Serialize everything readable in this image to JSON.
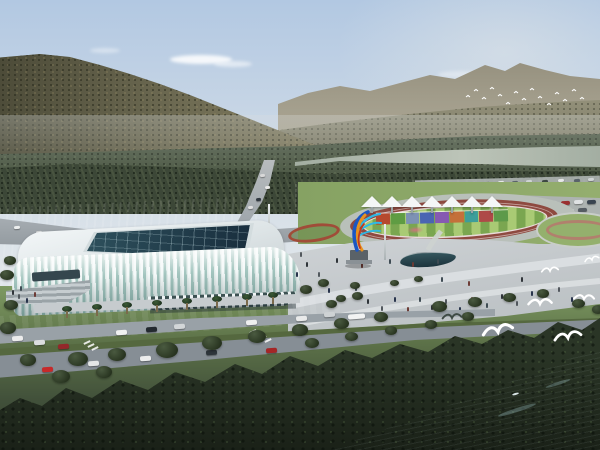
{
  "meta": {
    "description": "Aerial architectural rendering: white lattice-facade stadium beside a riverside sports park with running track, white canopy tents, rainbow sculpture, forested mountains behind and seagulls over the water"
  },
  "palette": {
    "sky_top": "#b2c8e2",
    "sky_mid": "#cbd8e6",
    "sky_low": "#e0e6ea",
    "cloud": "#ffffff",
    "ridge_far": "#938e7c",
    "slope": "#82806a",
    "mountain_main": "#6d6a52",
    "treeband": "#4e5a46",
    "treeband_dark": "#3c4737",
    "river": "#a3aea2",
    "river_light": "#bcc4b8",
    "field": "#7c9a5d",
    "field_light": "#94b06d",
    "road": "#99a1a7",
    "road_dark": "#868e95",
    "road_light": "#c6cbce",
    "plaza": "#c7cccf",
    "path_light": "#dbdfe1",
    "track": "#8e4a40",
    "apron": "#b9c0ba",
    "infield_a": "#a9ca74",
    "infield_b": "#7aa650",
    "tent": "#f4f6f6",
    "stadium_white": "#eff4f5",
    "stadium_glass": "#9cc1ba",
    "stadium_shadow": "#3c5152",
    "skylight": "#1d3343",
    "lawn": "#7b9b5e",
    "median": "#55683f",
    "forest": "#2a3526",
    "water_deep": "#16303a",
    "water_mid": "#2d4c57",
    "water_light": "#4a6a74",
    "bird": "#ffffff",
    "bird_dark": "#3e4a44",
    "sculpt_blue": "#1b57c2",
    "sculpt_cyan": "#2fb9e6",
    "sculpt_orange": "#e8921e",
    "sculpt_red": "#c23a1e",
    "pedestal": "#5a6268",
    "pool": "#1c333c"
  },
  "sky": {
    "clouds": [
      [
        170,
        55,
        62,
        9,
        0.85
      ],
      [
        214,
        61,
        38,
        6,
        0.55
      ],
      [
        438,
        71,
        46,
        7,
        0.35
      ],
      [
        90,
        48,
        30,
        5,
        0.4
      ]
    ]
  },
  "park": {
    "tents": [
      372,
      392,
      412,
      432,
      452,
      472,
      492
    ],
    "wall_blocks": [
      "#b6492e",
      "#5f9c43",
      "#7d92b4",
      "#4a65b2",
      "#8659b2",
      "#c4703a",
      "#3d9e9a",
      "#ae4a48",
      "#5d9a4a"
    ]
  },
  "vehicles": {
    "boulevard": [
      [
        12,
        336,
        "#ececec"
      ],
      [
        34,
        340,
        "#dcdedf"
      ],
      [
        58,
        344,
        "#93282a"
      ],
      [
        116,
        330,
        "#f0f1f1"
      ],
      [
        146,
        327,
        "#23292f"
      ],
      [
        174,
        324,
        "#d2d6d8"
      ],
      [
        246,
        320,
        "#eeefef"
      ],
      [
        266,
        348,
        "#a42626"
      ],
      [
        88,
        361,
        "#e4e6e6"
      ],
      [
        42,
        367,
        "#c62a2a"
      ],
      [
        140,
        356,
        "#eceded"
      ],
      [
        206,
        350,
        "#2e353b"
      ],
      [
        296,
        316,
        "#e9eaea"
      ],
      [
        324,
        312,
        "#ced2d4"
      ],
      [
        348,
        314,
        "#f2f3f3",
        17
      ]
    ],
    "upper": [
      [
        14,
        226,
        "#eceeee"
      ],
      [
        36,
        231,
        "#d8dada"
      ],
      [
        64,
        236,
        "#f0f0f0"
      ],
      [
        96,
        240,
        "#2a3036"
      ],
      [
        124,
        242,
        "#e8e8e8"
      ],
      [
        204,
        240,
        "#c23434"
      ],
      [
        226,
        236,
        "#e8e8e8"
      ]
    ],
    "mountain": [
      [
        260,
        174,
        "#d8d8d8"
      ],
      [
        265,
        186,
        "#e8e8e8"
      ],
      [
        256,
        198,
        "#303840"
      ],
      [
        248,
        206,
        "#e0e0e0"
      ]
    ],
    "service": [
      [
        428,
        184
      ],
      [
        442,
        183
      ],
      [
        456,
        183
      ],
      [
        470,
        182
      ],
      [
        484,
        182
      ],
      [
        498,
        181
      ],
      [
        512,
        181
      ],
      [
        526,
        180
      ],
      [
        542,
        180
      ],
      [
        558,
        179
      ],
      [
        574,
        179
      ],
      [
        588,
        178
      ]
    ],
    "service_colors": [
      "#3d4742",
      "#e6e8e8",
      "#59636a",
      "#cfd4d4"
    ],
    "parking": [
      [
        496,
        203,
        "#e8eaea"
      ],
      [
        509,
        203,
        "#6a7076"
      ],
      [
        522,
        202,
        "#c0c4c6"
      ],
      [
        535,
        202,
        "#2e3438"
      ],
      [
        548,
        201,
        "#e8eaea"
      ],
      [
        561,
        201,
        "#9a3030"
      ],
      [
        574,
        200,
        "#dfe2e3"
      ],
      [
        587,
        200,
        "#3a4450"
      ],
      [
        500,
        211,
        "#d8dbdc"
      ],
      [
        513,
        211,
        "#30404e"
      ],
      [
        526,
        210,
        "#e8eaea"
      ],
      [
        539,
        210,
        "#8a9096"
      ],
      [
        552,
        209,
        "#b03434"
      ],
      [
        565,
        209,
        "#e8eaea"
      ],
      [
        578,
        208,
        "#555c62"
      ],
      [
        504,
        218,
        "#e0e3e4"
      ],
      [
        518,
        218,
        "#394249"
      ],
      [
        532,
        217,
        "#e8eaea"
      ],
      [
        546,
        217,
        "#70787e"
      ]
    ]
  },
  "crosswalks": [
    [
      252,
      328
    ],
    [
      257,
      331
    ],
    [
      262,
      334
    ],
    [
      267,
      337
    ],
    [
      86,
      339
    ],
    [
      90,
      342
    ],
    [
      94,
      345
    ]
  ],
  "people": [
    [
      306,
      262
    ],
    [
      318,
      272
    ],
    [
      328,
      288
    ],
    [
      342,
      296
    ],
    [
      355,
      286
    ],
    [
      367,
      299
    ],
    [
      381,
      306
    ],
    [
      394,
      297
    ],
    [
      407,
      307
    ],
    [
      419,
      297
    ],
    [
      431,
      305
    ],
    [
      445,
      299
    ],
    [
      459,
      307
    ],
    [
      471,
      297
    ],
    [
      486,
      303
    ],
    [
      501,
      294
    ],
    [
      516,
      301
    ],
    [
      531,
      291
    ],
    [
      468,
      281
    ],
    [
      441,
      277
    ],
    [
      521,
      277
    ],
    [
      558,
      287
    ],
    [
      571,
      297
    ],
    [
      361,
      263
    ],
    [
      389,
      259
    ],
    [
      336,
      258
    ],
    [
      300,
      252
    ],
    [
      296,
      272
    ],
    [
      412,
      262
    ],
    [
      437,
      259
    ],
    [
      12,
      290
    ],
    [
      18,
      294
    ],
    [
      26,
      298
    ],
    [
      34,
      292
    ],
    [
      20,
      286
    ]
  ],
  "people_colors": [
    "#2e3338",
    "#50565c",
    "#26324a",
    "#6b3a34",
    "#3d4a52"
  ],
  "trees": [
    [
      68,
      352,
      20
    ],
    [
      108,
      348,
      18
    ],
    [
      156,
      342,
      22
    ],
    [
      202,
      336,
      20
    ],
    [
      248,
      330,
      18
    ],
    [
      292,
      324,
      16
    ],
    [
      334,
      318,
      15
    ],
    [
      374,
      312,
      14
    ],
    [
      20,
      354,
      16
    ],
    [
      52,
      370,
      18
    ],
    [
      96,
      366,
      16
    ],
    [
      305,
      338,
      14
    ],
    [
      345,
      332,
      13
    ],
    [
      385,
      326,
      12
    ],
    [
      425,
      320,
      12
    ],
    [
      462,
      312,
      12
    ],
    [
      432,
      301,
      15
    ],
    [
      468,
      297,
      14
    ],
    [
      503,
      293,
      13
    ],
    [
      537,
      289,
      12
    ],
    [
      572,
      299,
      13
    ],
    [
      592,
      305,
      12
    ],
    [
      300,
      285,
      12
    ],
    [
      318,
      279,
      11
    ],
    [
      336,
      295,
      10
    ],
    [
      4,
      300,
      14
    ],
    [
      0,
      322,
      16
    ],
    [
      414,
      276,
      9
    ],
    [
      390,
      280,
      9
    ],
    [
      350,
      282,
      10
    ],
    [
      326,
      300,
      11
    ],
    [
      352,
      292,
      11
    ],
    [
      4,
      256,
      12
    ],
    [
      0,
      270,
      14
    ]
  ],
  "palms": [
    [
      62,
      306
    ],
    [
      92,
      304
    ],
    [
      122,
      302
    ],
    [
      152,
      300
    ],
    [
      182,
      298
    ],
    [
      212,
      296
    ],
    [
      242,
      294
    ],
    [
      268,
      292
    ]
  ],
  "poles": [
    [
      268,
      204,
      36
    ],
    [
      384,
      224,
      36
    ]
  ],
  "birds": {
    "distant": [
      [
        468,
        97
      ],
      [
        476,
        91
      ],
      [
        484,
        99
      ],
      [
        492,
        89
      ],
      [
        500,
        96
      ],
      [
        508,
        104
      ],
      [
        516,
        93
      ],
      [
        524,
        100
      ],
      [
        532,
        90
      ],
      [
        540,
        98
      ],
      [
        549,
        105
      ],
      [
        557,
        94
      ],
      [
        565,
        101
      ],
      [
        574,
        91
      ],
      [
        582,
        99
      ]
    ],
    "gulls": [
      [
        498,
        332,
        1.35,
        -6,
        0
      ],
      [
        540,
        304,
        1.05,
        4,
        0
      ],
      [
        568,
        338,
        1.2,
        -4,
        0
      ],
      [
        584,
        299,
        0.9,
        8,
        0
      ],
      [
        550,
        271,
        0.75,
        0,
        0
      ],
      [
        592,
        260,
        0.65,
        -8,
        0
      ],
      [
        452,
        318,
        0.85,
        3,
        1
      ]
    ]
  },
  "water_details": {
    "streaks": [
      [
        497,
        408,
        40,
        4
      ],
      [
        545,
        382,
        26,
        3
      ]
    ],
    "boat": [
      512,
      393
    ]
  }
}
